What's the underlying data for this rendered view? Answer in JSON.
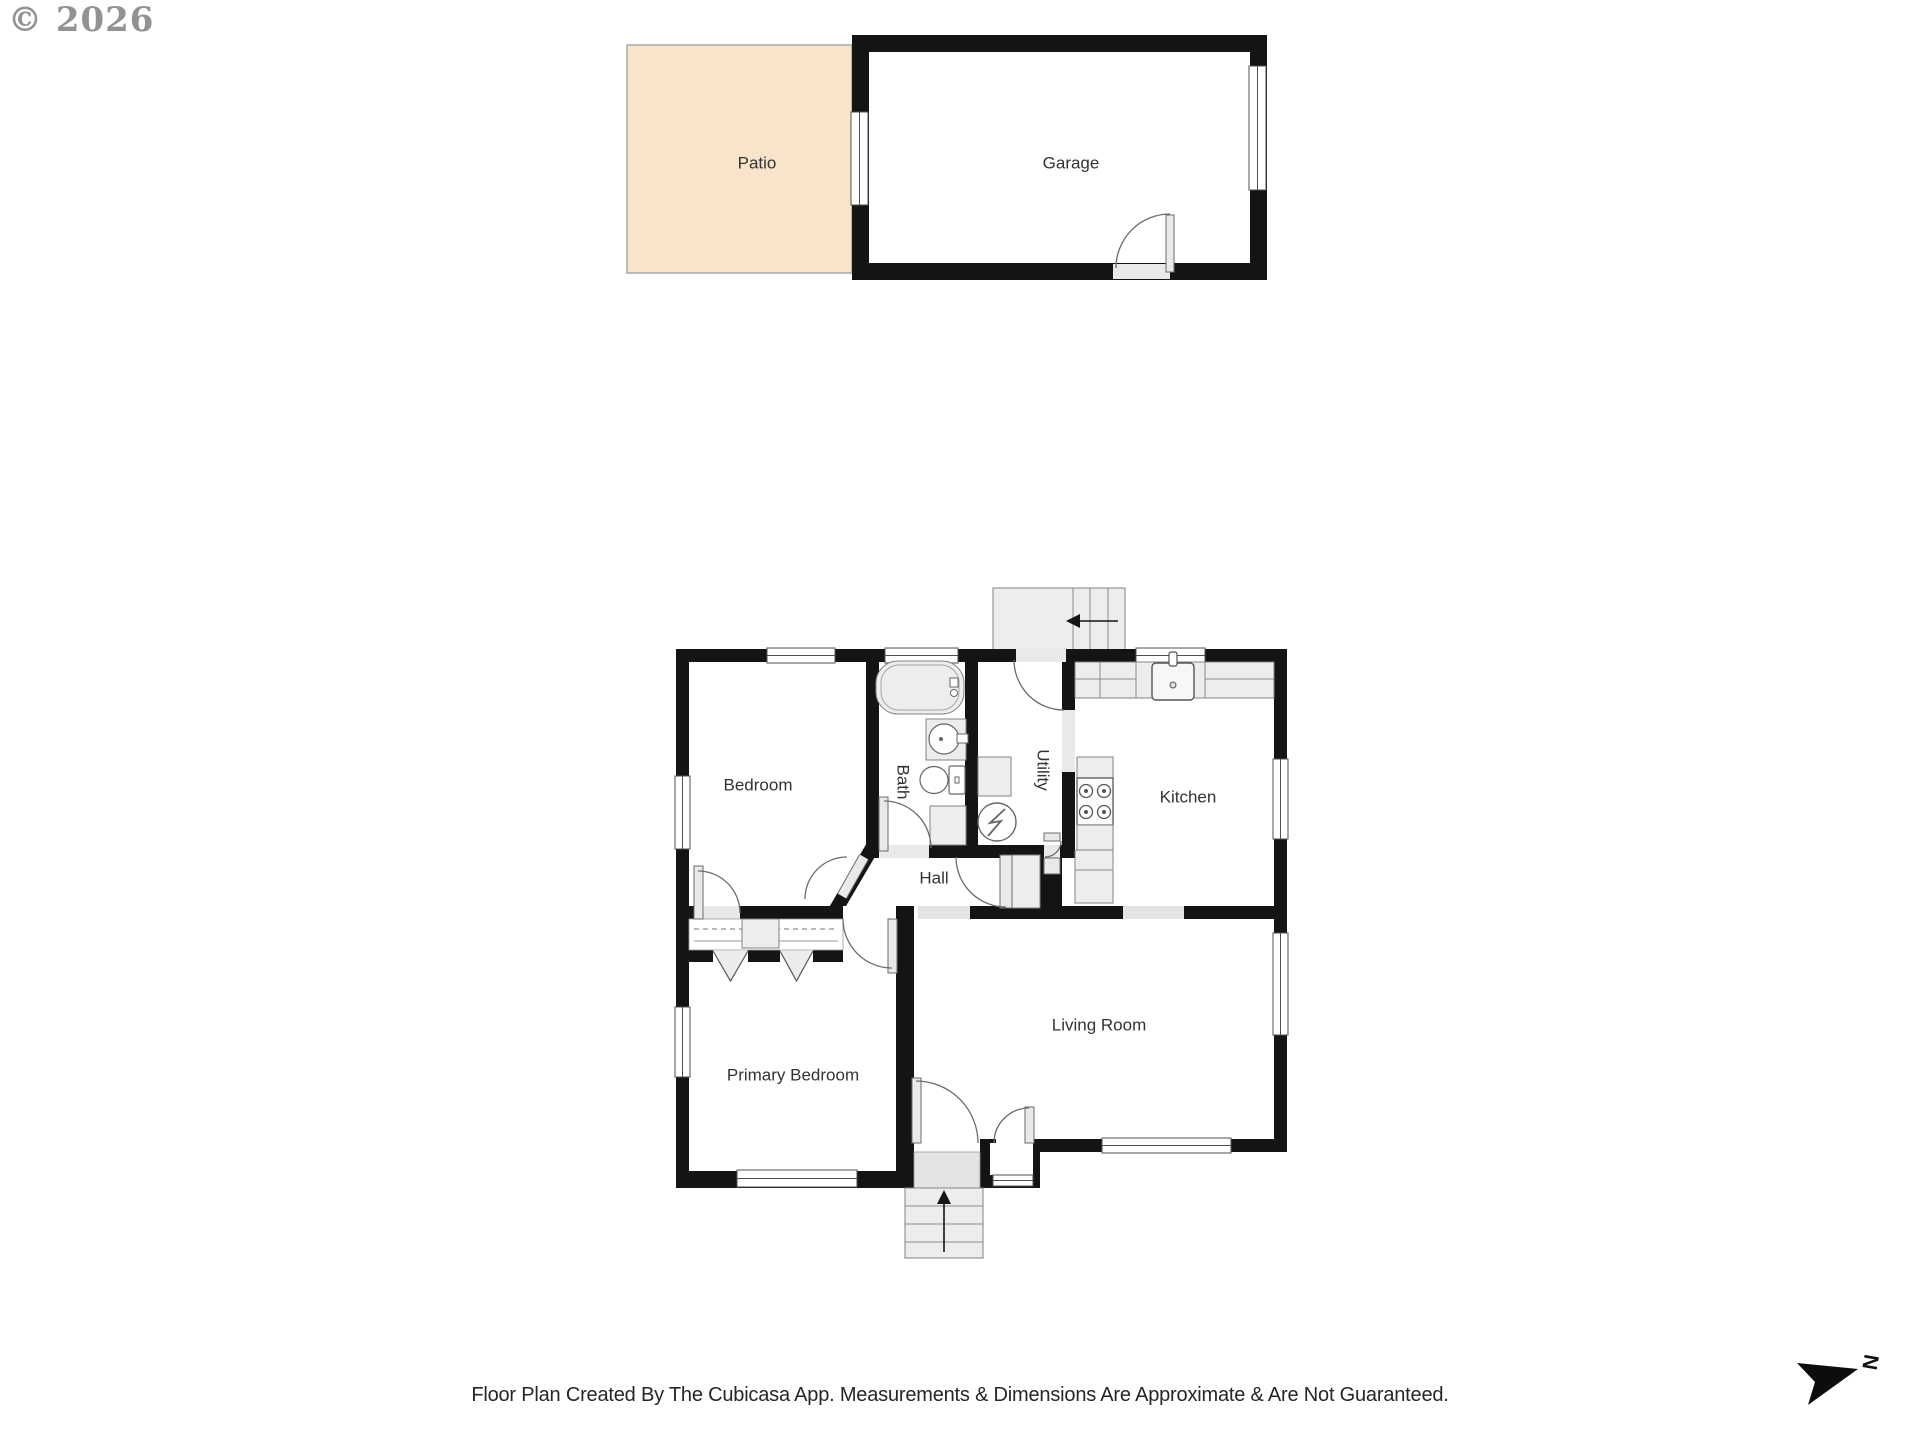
{
  "watermark": {
    "text": "© 2026"
  },
  "rooms": {
    "patio": {
      "label": "Patio"
    },
    "garage": {
      "label": "Garage"
    },
    "bedroom": {
      "label": "Bedroom"
    },
    "bath": {
      "label": "Bath"
    },
    "utility": {
      "label": "Utility"
    },
    "kitchen": {
      "label": "Kitchen"
    },
    "hall": {
      "label": "Hall"
    },
    "primary_bedroom": {
      "label": "Primary Bedroom"
    },
    "living_room": {
      "label": "Living Room"
    }
  },
  "compass": {
    "north_label": "N"
  },
  "footer": {
    "disclaimer": "Floor Plan Created By The Cubicasa App. Measurements & Dimensions Are Approximate & Are Not Guaranteed."
  },
  "colors": {
    "wall": "#141414",
    "patio_fill": "#f8e3cb",
    "fixture_fill": "#ededed",
    "label_text": "#333333"
  }
}
